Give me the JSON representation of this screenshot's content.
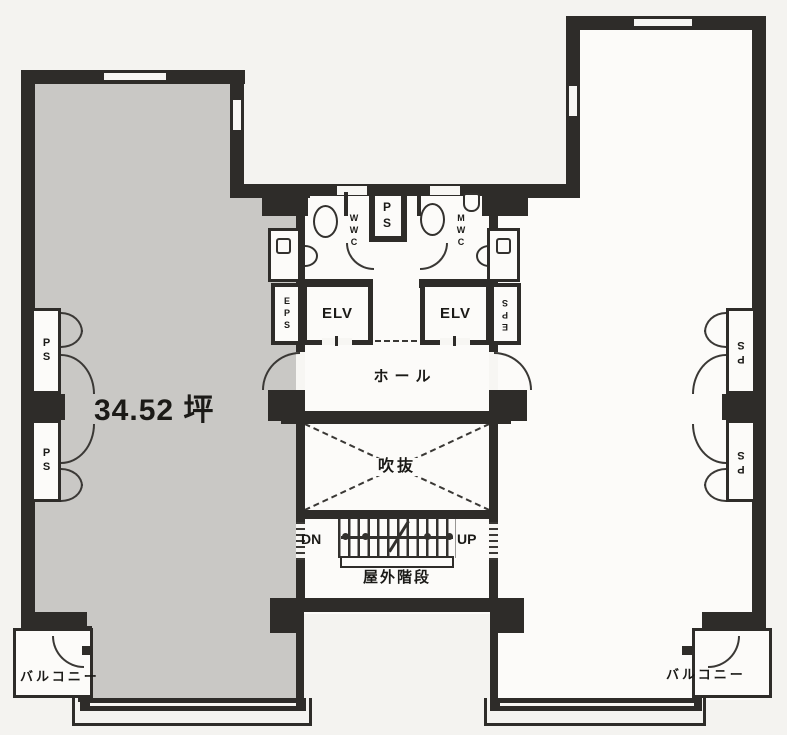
{
  "labels": {
    "area": "34.52 坪",
    "hall": "ホール",
    "atrium": "吹抜",
    "outdoor_stairs": "屋外階段",
    "down": "DN",
    "up": "UP",
    "elevator": "ELV",
    "eps": "EPS",
    "ps": "PS",
    "wc_women": "WWC",
    "wc_men": "MWC",
    "balcony": "バルコニー"
  },
  "colors": {
    "wall": "#2e2c29",
    "room_gray_fill": "#c9c8c5",
    "room_white_fill": "#fcfbf9",
    "background": "#f4f3f0",
    "line": "#3a3835",
    "text": "#1b1a17"
  }
}
